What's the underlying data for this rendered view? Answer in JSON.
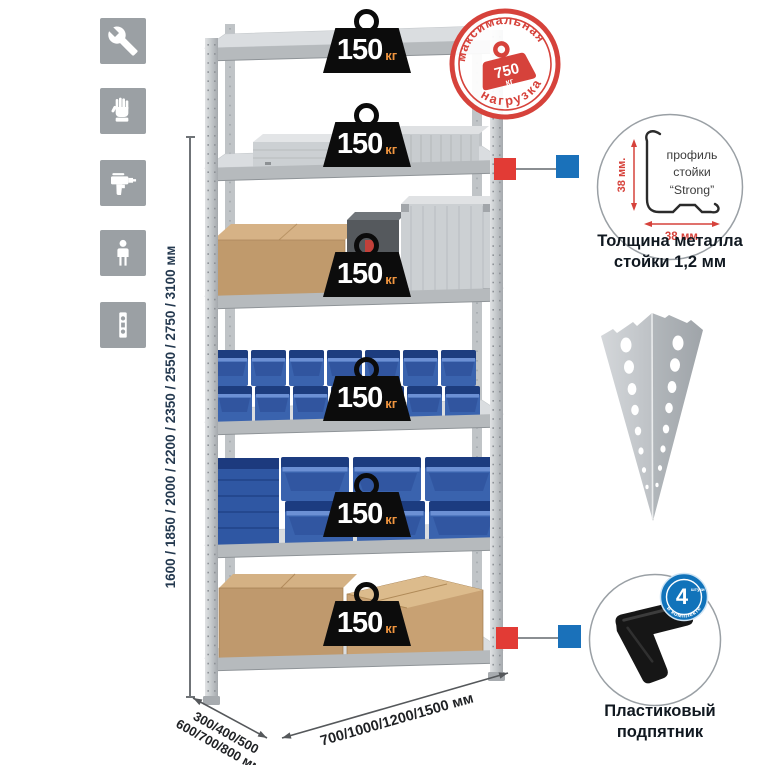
{
  "colors": {
    "stamp_red": "#d6423b",
    "marker_red": "#e23b35",
    "marker_blue": "#1a71ba",
    "bin_blue": "#3a63ae",
    "metal_gray": "#c6cacd",
    "cardboard": "#c09a6c",
    "icon_tile_gray": "#9ba0a4",
    "badge_black": "#0c0c0c",
    "badge_unit_orange": "#f0953f",
    "dimension_text": "#24394f"
  },
  "left_toolbar": {
    "icons": [
      {
        "name": "wrench-icon"
      },
      {
        "name": "gloves-icon"
      },
      {
        "name": "drill-icon"
      },
      {
        "name": "person-icon"
      },
      {
        "name": "post-profile-icon"
      }
    ]
  },
  "dimensions": {
    "height_label": "1600 / 1850 / 2000 / 2200 / 2350 / 2550 / 2750 / 3100 мм",
    "depth_label_line1": "300/400/500",
    "depth_label_line2": "600/700/800 мм",
    "width_label": "700/1000/1200/1500 мм"
  },
  "shelf_load_badge": {
    "value": "150",
    "unit": "кг"
  },
  "max_load_stamp": {
    "arc_top": "максимальная",
    "arc_bottom": "нагрузка",
    "weight_value": "750",
    "weight_unit": "кг"
  },
  "post_profile_detail": {
    "dim_vertical": "38 мм.",
    "dim_horizontal": "38 мм.",
    "label_line1": "профиль",
    "label_line2": "стойки",
    "label_line3": "“Strong”",
    "caption_line1": "Толщина металла",
    "caption_line2": "стойки 1,2 мм"
  },
  "foot_detail": {
    "badge_number": "4",
    "badge_small_text": "штуки",
    "badge_arc_text": "в комплекте",
    "caption_line1": "Пластиковый",
    "caption_line2": "подпятник"
  }
}
